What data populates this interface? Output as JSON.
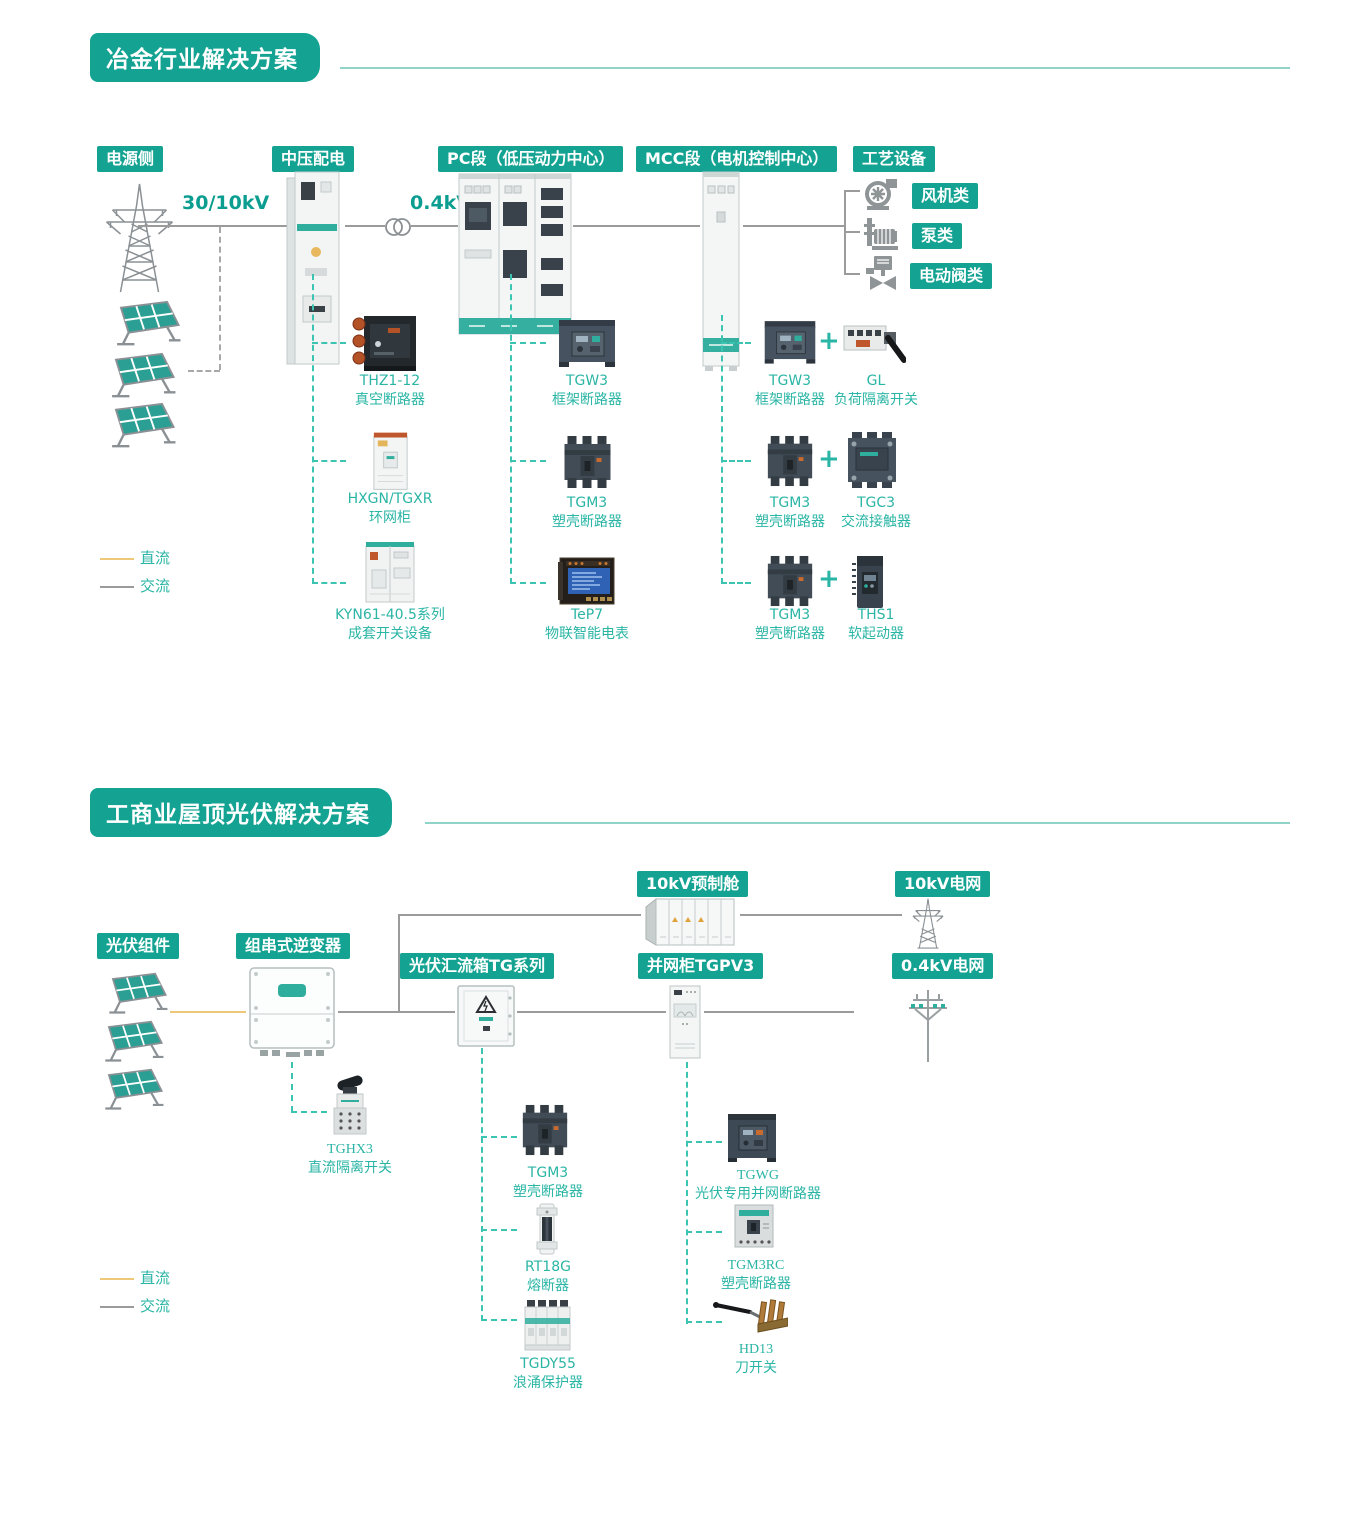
{
  "colors": {
    "accent_teal": "#14A392",
    "underline_teal": "#8FD3C9",
    "dashed_connector_teal": "#3CC4B3",
    "product_text_teal": "#2AB5A5",
    "voltage_text_teal": "#0B9E90",
    "ac_line_gray": "#9B9B9B",
    "dc_line_yellow": "#ECC878",
    "icon_gray": "#8F9496"
  },
  "s1": {
    "title": "冶金行业解决方案",
    "stages": {
      "source": "电源侧",
      "mv": "中压配电",
      "pc": "PC段（低压动力中心）",
      "mcc": "MCC段（电机控制中心）",
      "process": "工艺设备"
    },
    "voltage_primary": "30/10kV",
    "voltage_secondary": "0.4kV",
    "plus": "+",
    "equipment": [
      {
        "label": "风机类"
      },
      {
        "label": "泵类"
      },
      {
        "label": "电动阀类"
      }
    ],
    "legend": {
      "dc": "直流",
      "ac": "交流"
    },
    "col_mv": [
      {
        "name": "THZ1-12",
        "desc": "真空断路器"
      },
      {
        "name": "HXGN/TGXR",
        "desc": "环网柜"
      },
      {
        "name": "KYN61-40.5系列",
        "desc": "成套开关设备"
      }
    ],
    "col_pc": [
      {
        "name": "TGW3",
        "desc": "框架断路器"
      },
      {
        "name": "TGM3",
        "desc": "塑壳断路器"
      },
      {
        "name": "TeP7",
        "desc": "物联智能电表"
      }
    ],
    "col_mcc": [
      {
        "a": {
          "name": "TGW3",
          "desc": "框架断路器"
        },
        "b": {
          "name": "GL",
          "desc": "负荷隔离开关"
        }
      },
      {
        "a": {
          "name": "TGM3",
          "desc": "塑壳断路器"
        },
        "b": {
          "name": "TGC3",
          "desc": "交流接触器"
        }
      },
      {
        "a": {
          "name": "TGM3",
          "desc": "塑壳断路器"
        },
        "b": {
          "name": "THS1",
          "desc": "软起动器"
        }
      }
    ]
  },
  "s2": {
    "title": "工商业屋顶光伏解决方案",
    "stages": {
      "pv": "光伏组件",
      "inverter": "组串式逆变器",
      "combiner": "光伏汇流箱TG系列",
      "grid_cabinet": "并网柜TGPV3",
      "cabin": "10kV预制舱",
      "grid10": "10kV电网",
      "grid04": "0.4kV电网"
    },
    "legend": {
      "dc": "直流",
      "ac": "交流"
    },
    "dc_switch": {
      "name": "TGHX3",
      "desc": "直流隔离开关"
    },
    "col_combiner": [
      {
        "name": "TGM3",
        "desc": "塑壳断路器"
      },
      {
        "name": "RT18G",
        "desc": "熔断器"
      },
      {
        "name": "TGDY55",
        "desc": "浪涌保护器"
      }
    ],
    "col_grid": [
      {
        "name": "TGWG",
        "desc": "光伏专用并网断路器"
      },
      {
        "name": "TGM3RC",
        "desc": "塑壳断路器"
      },
      {
        "name": "HD13",
        "desc": "刀开关"
      }
    ]
  }
}
